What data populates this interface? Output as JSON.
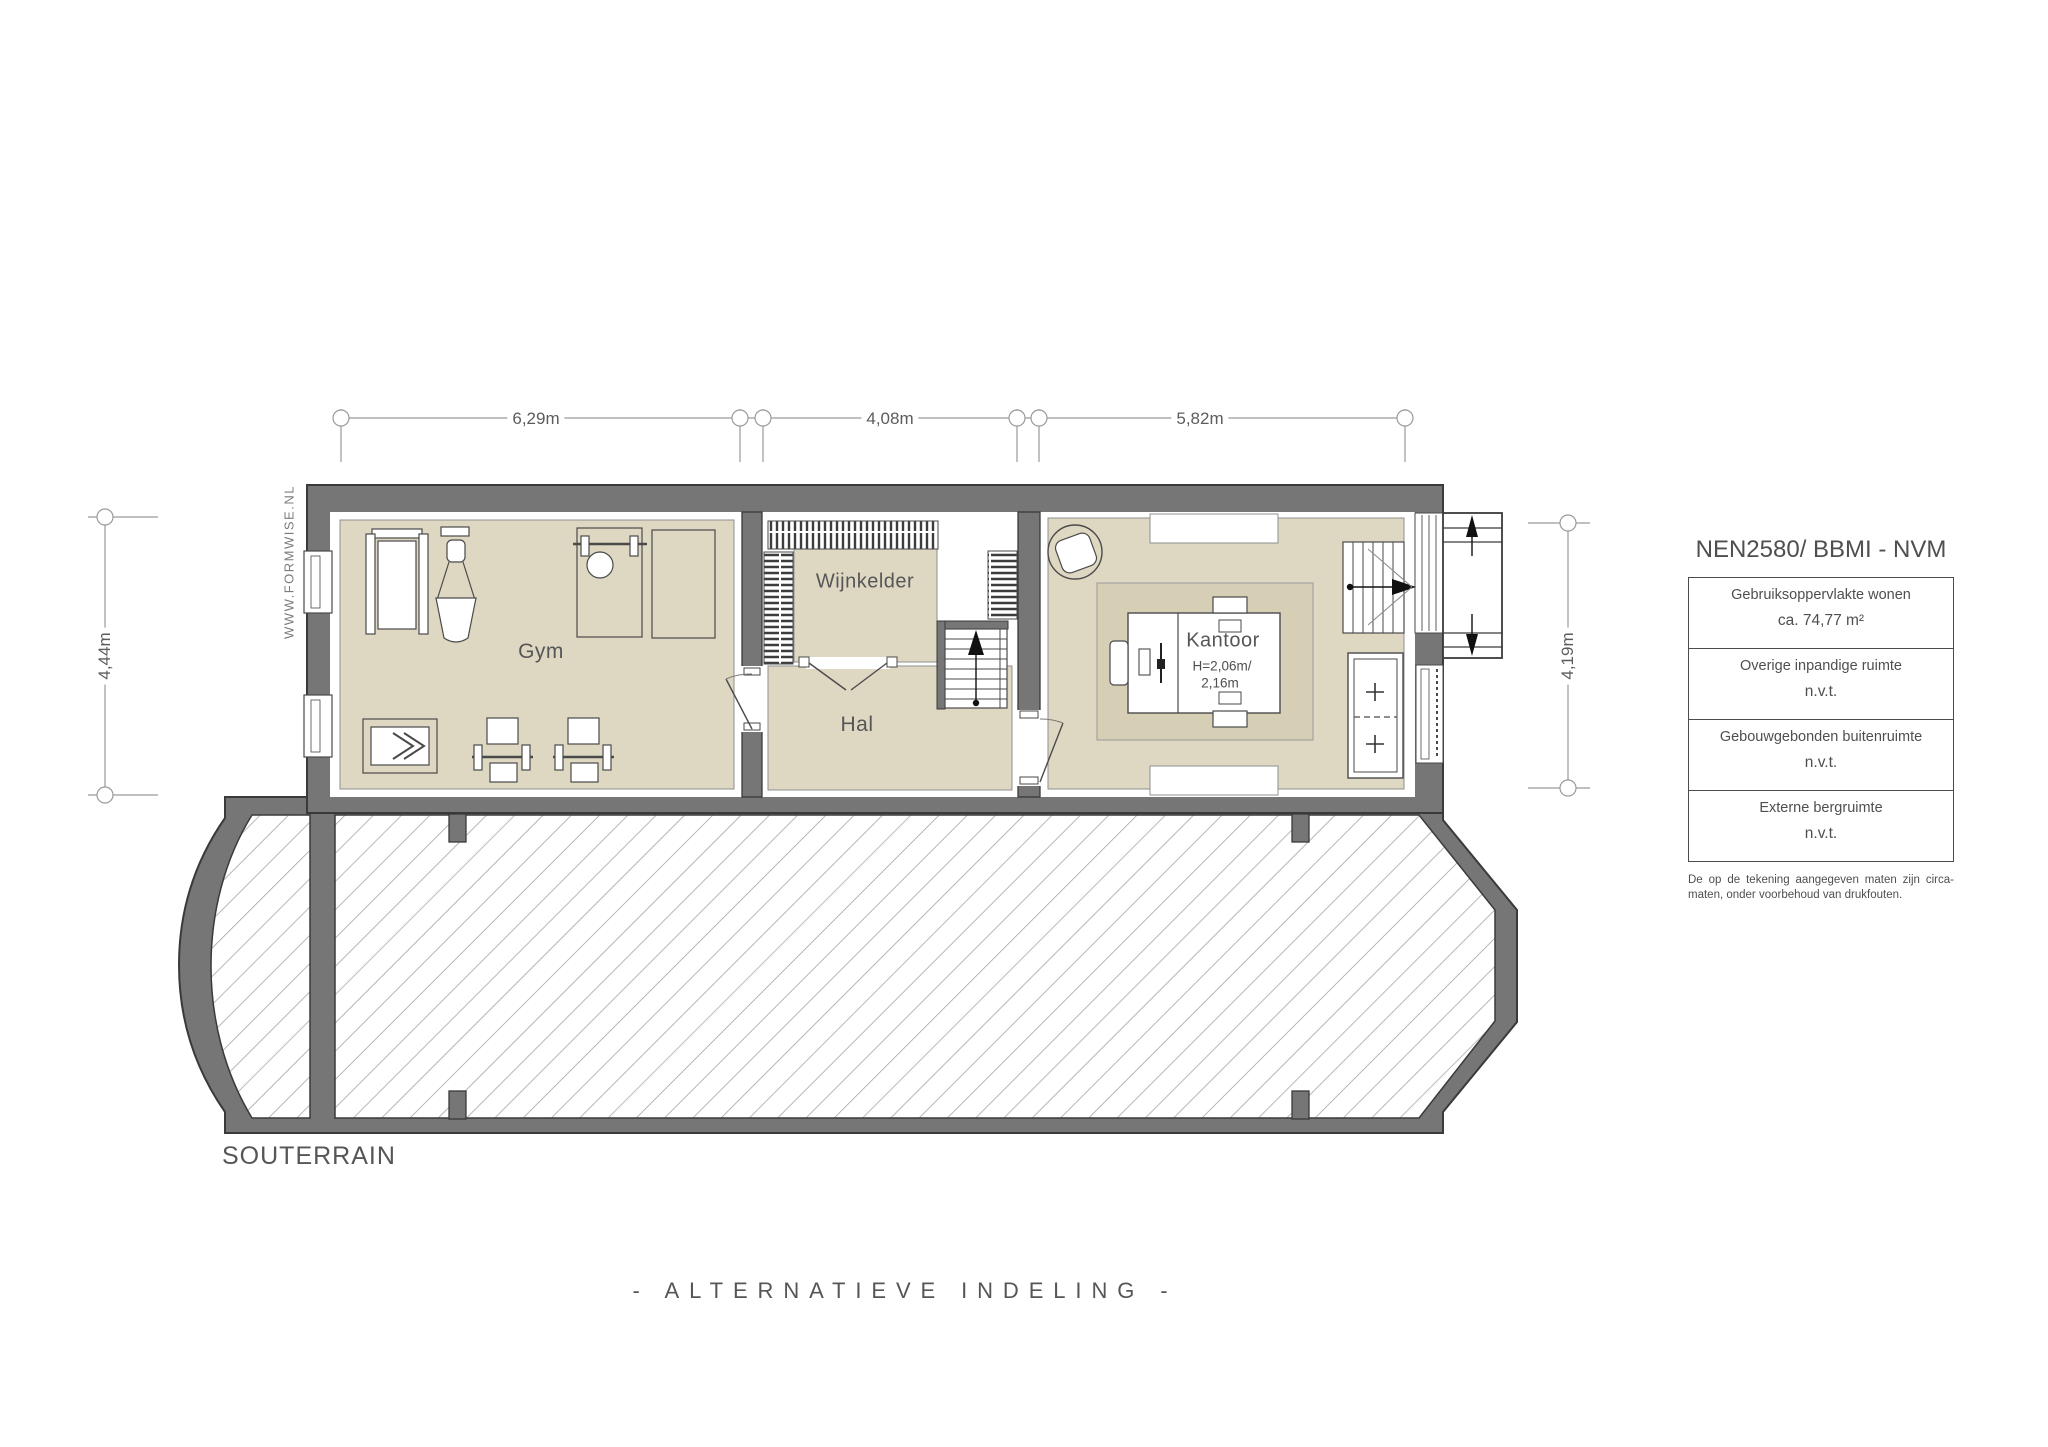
{
  "watermark": {
    "text": "WWW.FORMWISE.NL"
  },
  "floor_label": "SOUTERRAIN",
  "footer": {
    "title": "- ALTERNATIEVE INDELING -"
  },
  "rooms": {
    "gym": {
      "label": "Gym"
    },
    "wijnkelder": {
      "label": "Wijnkelder"
    },
    "hal": {
      "label": "Hal"
    },
    "kantoor": {
      "label": "Kantoor",
      "height_note": [
        "H=2,06m/",
        "2,16m"
      ]
    }
  },
  "dimensions": {
    "top": [
      {
        "label": "6,29m"
      },
      {
        "label": "4,08m"
      },
      {
        "label": "5,82m"
      }
    ],
    "left": {
      "label": "4,44m"
    },
    "right": {
      "label": "4,19m"
    }
  },
  "legend": {
    "title": "NEN2580/ BBMI - NVM",
    "rows": [
      {
        "label": "Gebruiksoppervlakte wonen",
        "value": "ca. 74,77 m²"
      },
      {
        "label": "Overige inpandige ruimte",
        "value": "n.v.t."
      },
      {
        "label": "Gebouwgebonden buitenruimte",
        "value": "n.v.t."
      },
      {
        "label": "Externe bergruimte",
        "value": "n.v.t."
      }
    ],
    "footnote": "De op de tekening aangegeven maten zijn circa-maten, onder voorbehoud van drukfouten."
  },
  "colors": {
    "wall": "#767676",
    "floor": "#ded8c2",
    "rug": "#d6cfb5",
    "hatch_line": "#a5a5a5",
    "dimension": "#9a9a9a"
  }
}
